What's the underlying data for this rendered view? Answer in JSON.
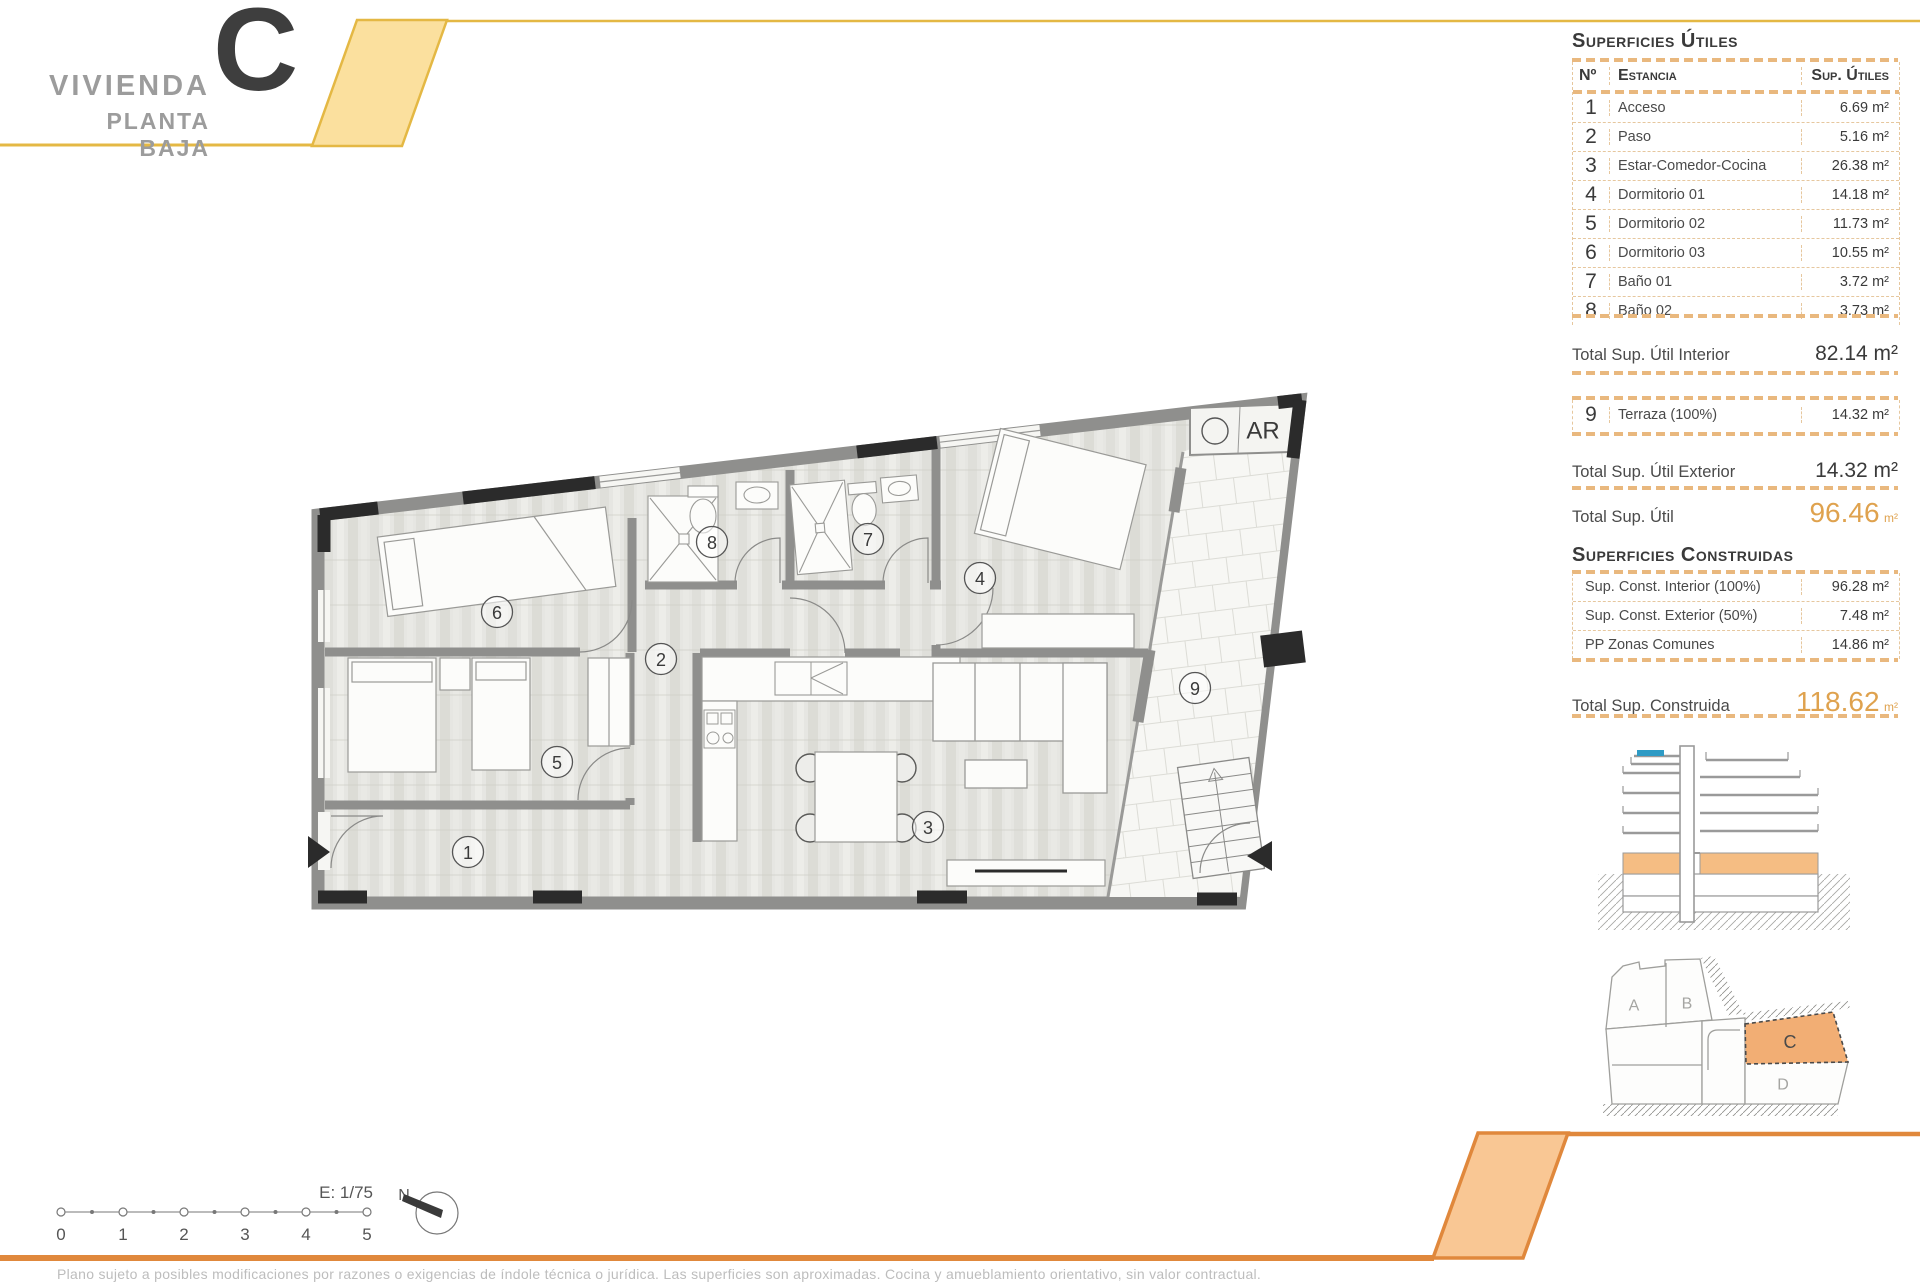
{
  "title": {
    "project": "VIVIENDA",
    "unit": "C",
    "floor": "PLANTA BAJA"
  },
  "colors": {
    "accent_yellow": "#E4B844",
    "accent_yellow_fill": "#FBE09E",
    "accent_orange": "#E0883C",
    "accent_orange_fill": "#F9C794",
    "highlight_unit_fill": "#F2AE74",
    "total_value_orange": "#DFA24E",
    "section_floor_orange": "#F5BD83",
    "section_pool_blue": "#2E9BC5"
  },
  "panel": {
    "utiles": {
      "heading": "Superficies Útiles",
      "columns": {
        "num": "Nº",
        "room": "Estancia",
        "area": "Sup. Útiles"
      },
      "rows": [
        {
          "num": "1",
          "room": "Acceso",
          "area": "6.69 m²"
        },
        {
          "num": "2",
          "room": "Paso",
          "area": "5.16 m²"
        },
        {
          "num": "3",
          "room": "Estar-Comedor-Cocina",
          "area": "26.38 m²"
        },
        {
          "num": "4",
          "room": "Dormitorio 01",
          "area": "14.18 m²"
        },
        {
          "num": "5",
          "room": "Dormitorio 02",
          "area": "11.73 m²"
        },
        {
          "num": "6",
          "room": "Dormitorio 03",
          "area": "10.55 m²"
        },
        {
          "num": "7",
          "room": "Baño 01",
          "area": "3.72 m²"
        },
        {
          "num": "8",
          "room": "Baño 02",
          "area": "3.73 m²"
        }
      ],
      "total_interior": {
        "label": "Total Sup. Útil Interior",
        "value": "82.14 m²"
      },
      "terraza": {
        "num": "9",
        "room": "Terraza (100%)",
        "area": "14.32 m²"
      },
      "total_exterior": {
        "label": "Total Sup. Útil Exterior",
        "value": "14.32 m²"
      },
      "total": {
        "label": "Total Sup. Útil",
        "value": "96.46",
        "unit": "m²"
      }
    },
    "construidas": {
      "heading": "Superficies Construidas",
      "rows": [
        {
          "label": "Sup. Const. Interior (100%)",
          "value": "96.28 m²"
        },
        {
          "label": "Sup. Const. Exterior (50%)",
          "value": "7.48 m²"
        },
        {
          "label": "PP Zonas Comunes",
          "value": "14.86 m²"
        }
      ],
      "total": {
        "label": "Total Sup. Construida",
        "value": "118.62",
        "unit": "m²"
      }
    }
  },
  "plan": {
    "room_labels": [
      "1",
      "2",
      "3",
      "4",
      "5",
      "6",
      "7",
      "8",
      "9"
    ],
    "ar_label": "AR"
  },
  "site_plan": {
    "labels": {
      "a": "A",
      "b": "B",
      "c": "C",
      "d": "D"
    }
  },
  "scale_bar": {
    "scale_label": "E: 1/75",
    "ticks": [
      "0",
      "1",
      "2",
      "3",
      "4",
      "5"
    ],
    "north_label": "N"
  },
  "footer": {
    "disclaimer": "Plano sujeto a posibles modificaciones por razones o exigencias de índole técnica o jurídica. Las superficies son aproximadas. Cocina y amueblamiento orientativo, sin valor contractual."
  }
}
